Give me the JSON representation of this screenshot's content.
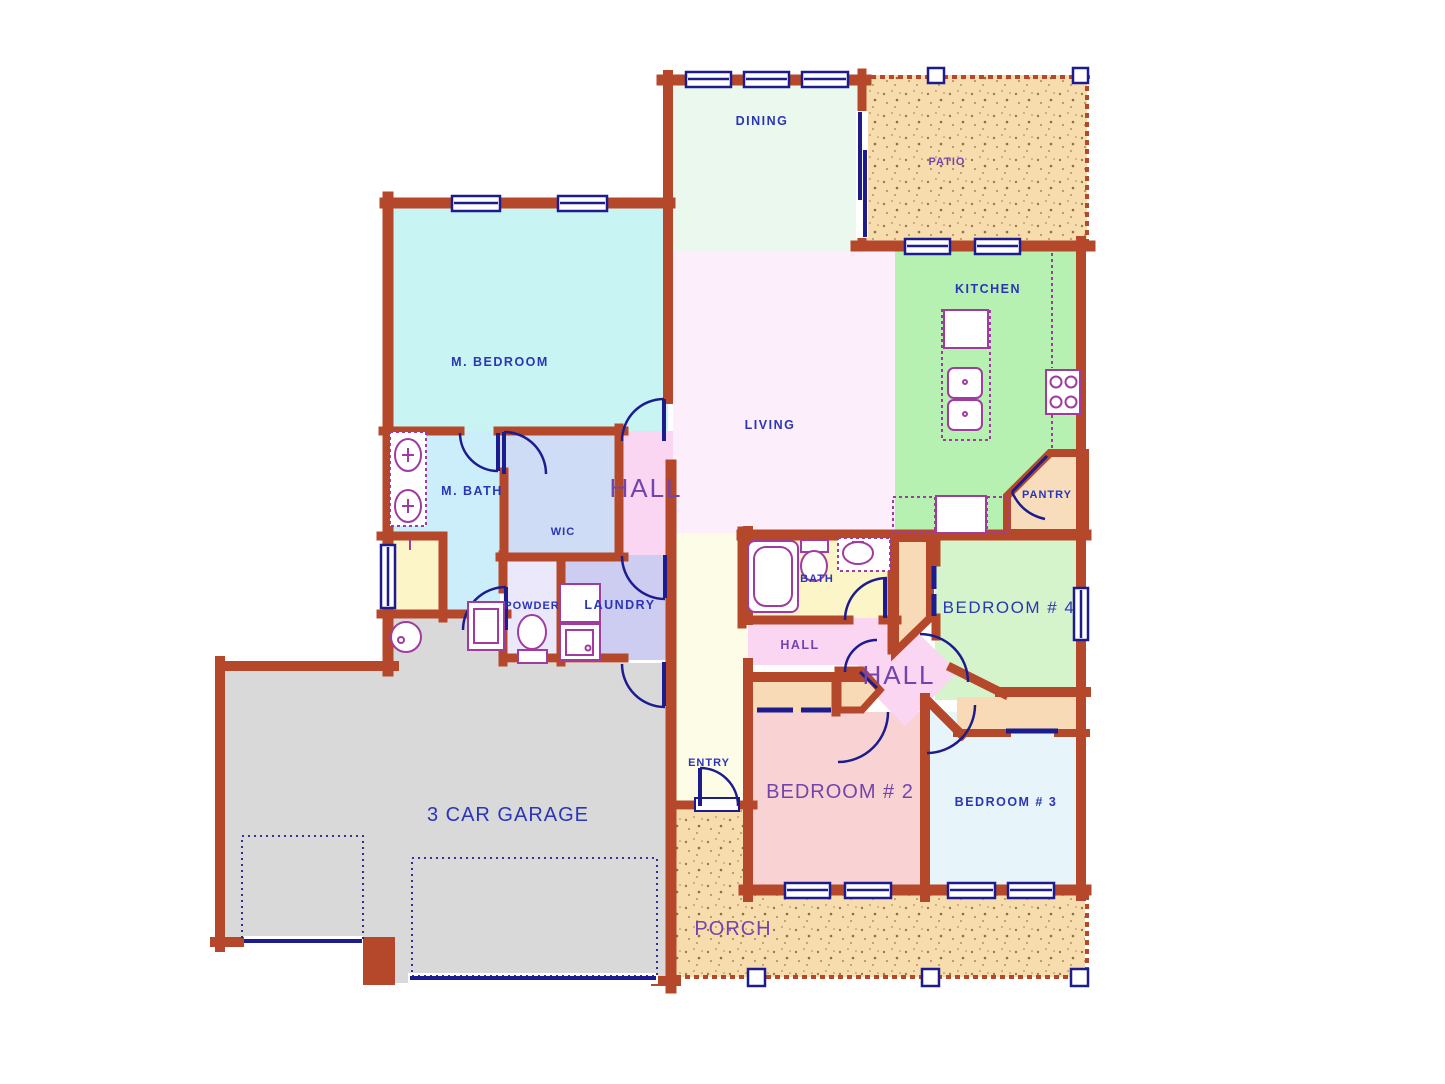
{
  "plan_title": "Single story house floor plan",
  "palette": {
    "wall": "#b5482a",
    "window": "#1c1c8f",
    "fixture": "#a03ca0",
    "label_blue": "#2a35b8",
    "label_purple": "#7244ac",
    "paving": "#f7dcae",
    "closet": "#f8dab6",
    "yellow_room": "#fbf5c8"
  },
  "rooms": {
    "dining": {
      "label": "DINING",
      "fill": "#eaf8ee"
    },
    "patio": {
      "label": "PATIO",
      "fill": "#f7dcae"
    },
    "kitchen": {
      "label": "KITCHEN",
      "fill": "#b7f1b1"
    },
    "pantry": {
      "label": "PANTRY",
      "fill": "#f8ddbc"
    },
    "living": {
      "label": "LIVING",
      "fill": "#fccolor"
    },
    "living2": {
      "label": "LIVING",
      "fill": "#fceefb"
    },
    "m_bedroom": {
      "label": "M. BEDROOM",
      "fill": "#c8f4f4"
    },
    "m_bath": {
      "label": "M. BATH",
      "fill": "#cbeefa"
    },
    "wic": {
      "label": "WIC",
      "fill": "#cfdcf5"
    },
    "hall": {
      "label": "HALL",
      "fill": "#fbd6f3"
    },
    "powder": {
      "label": "POWDER",
      "fill": "#ece8fb"
    },
    "laundry": {
      "label": "LAUNDRY",
      "fill": "#cdcdf1"
    },
    "bath": {
      "label": "BATH",
      "fill": "#fbf5c8"
    },
    "bedroom4": {
      "label": "BEDROOM # 4",
      "fill": "#d6f4cb"
    },
    "bedroom2": {
      "label": "BEDROOM # 2",
      "fill": "#f9d3d3"
    },
    "bedroom3": {
      "label": "BEDROOM # 3",
      "fill": "#e7f5fa"
    },
    "entry": {
      "label": "ENTRY",
      "fill": "#fdfce7"
    },
    "porch": {
      "label": "PORCH",
      "fill": "#f7dcae"
    },
    "garage": {
      "label": "3 CAR GARAGE",
      "fill": "#d9d9d9"
    }
  }
}
